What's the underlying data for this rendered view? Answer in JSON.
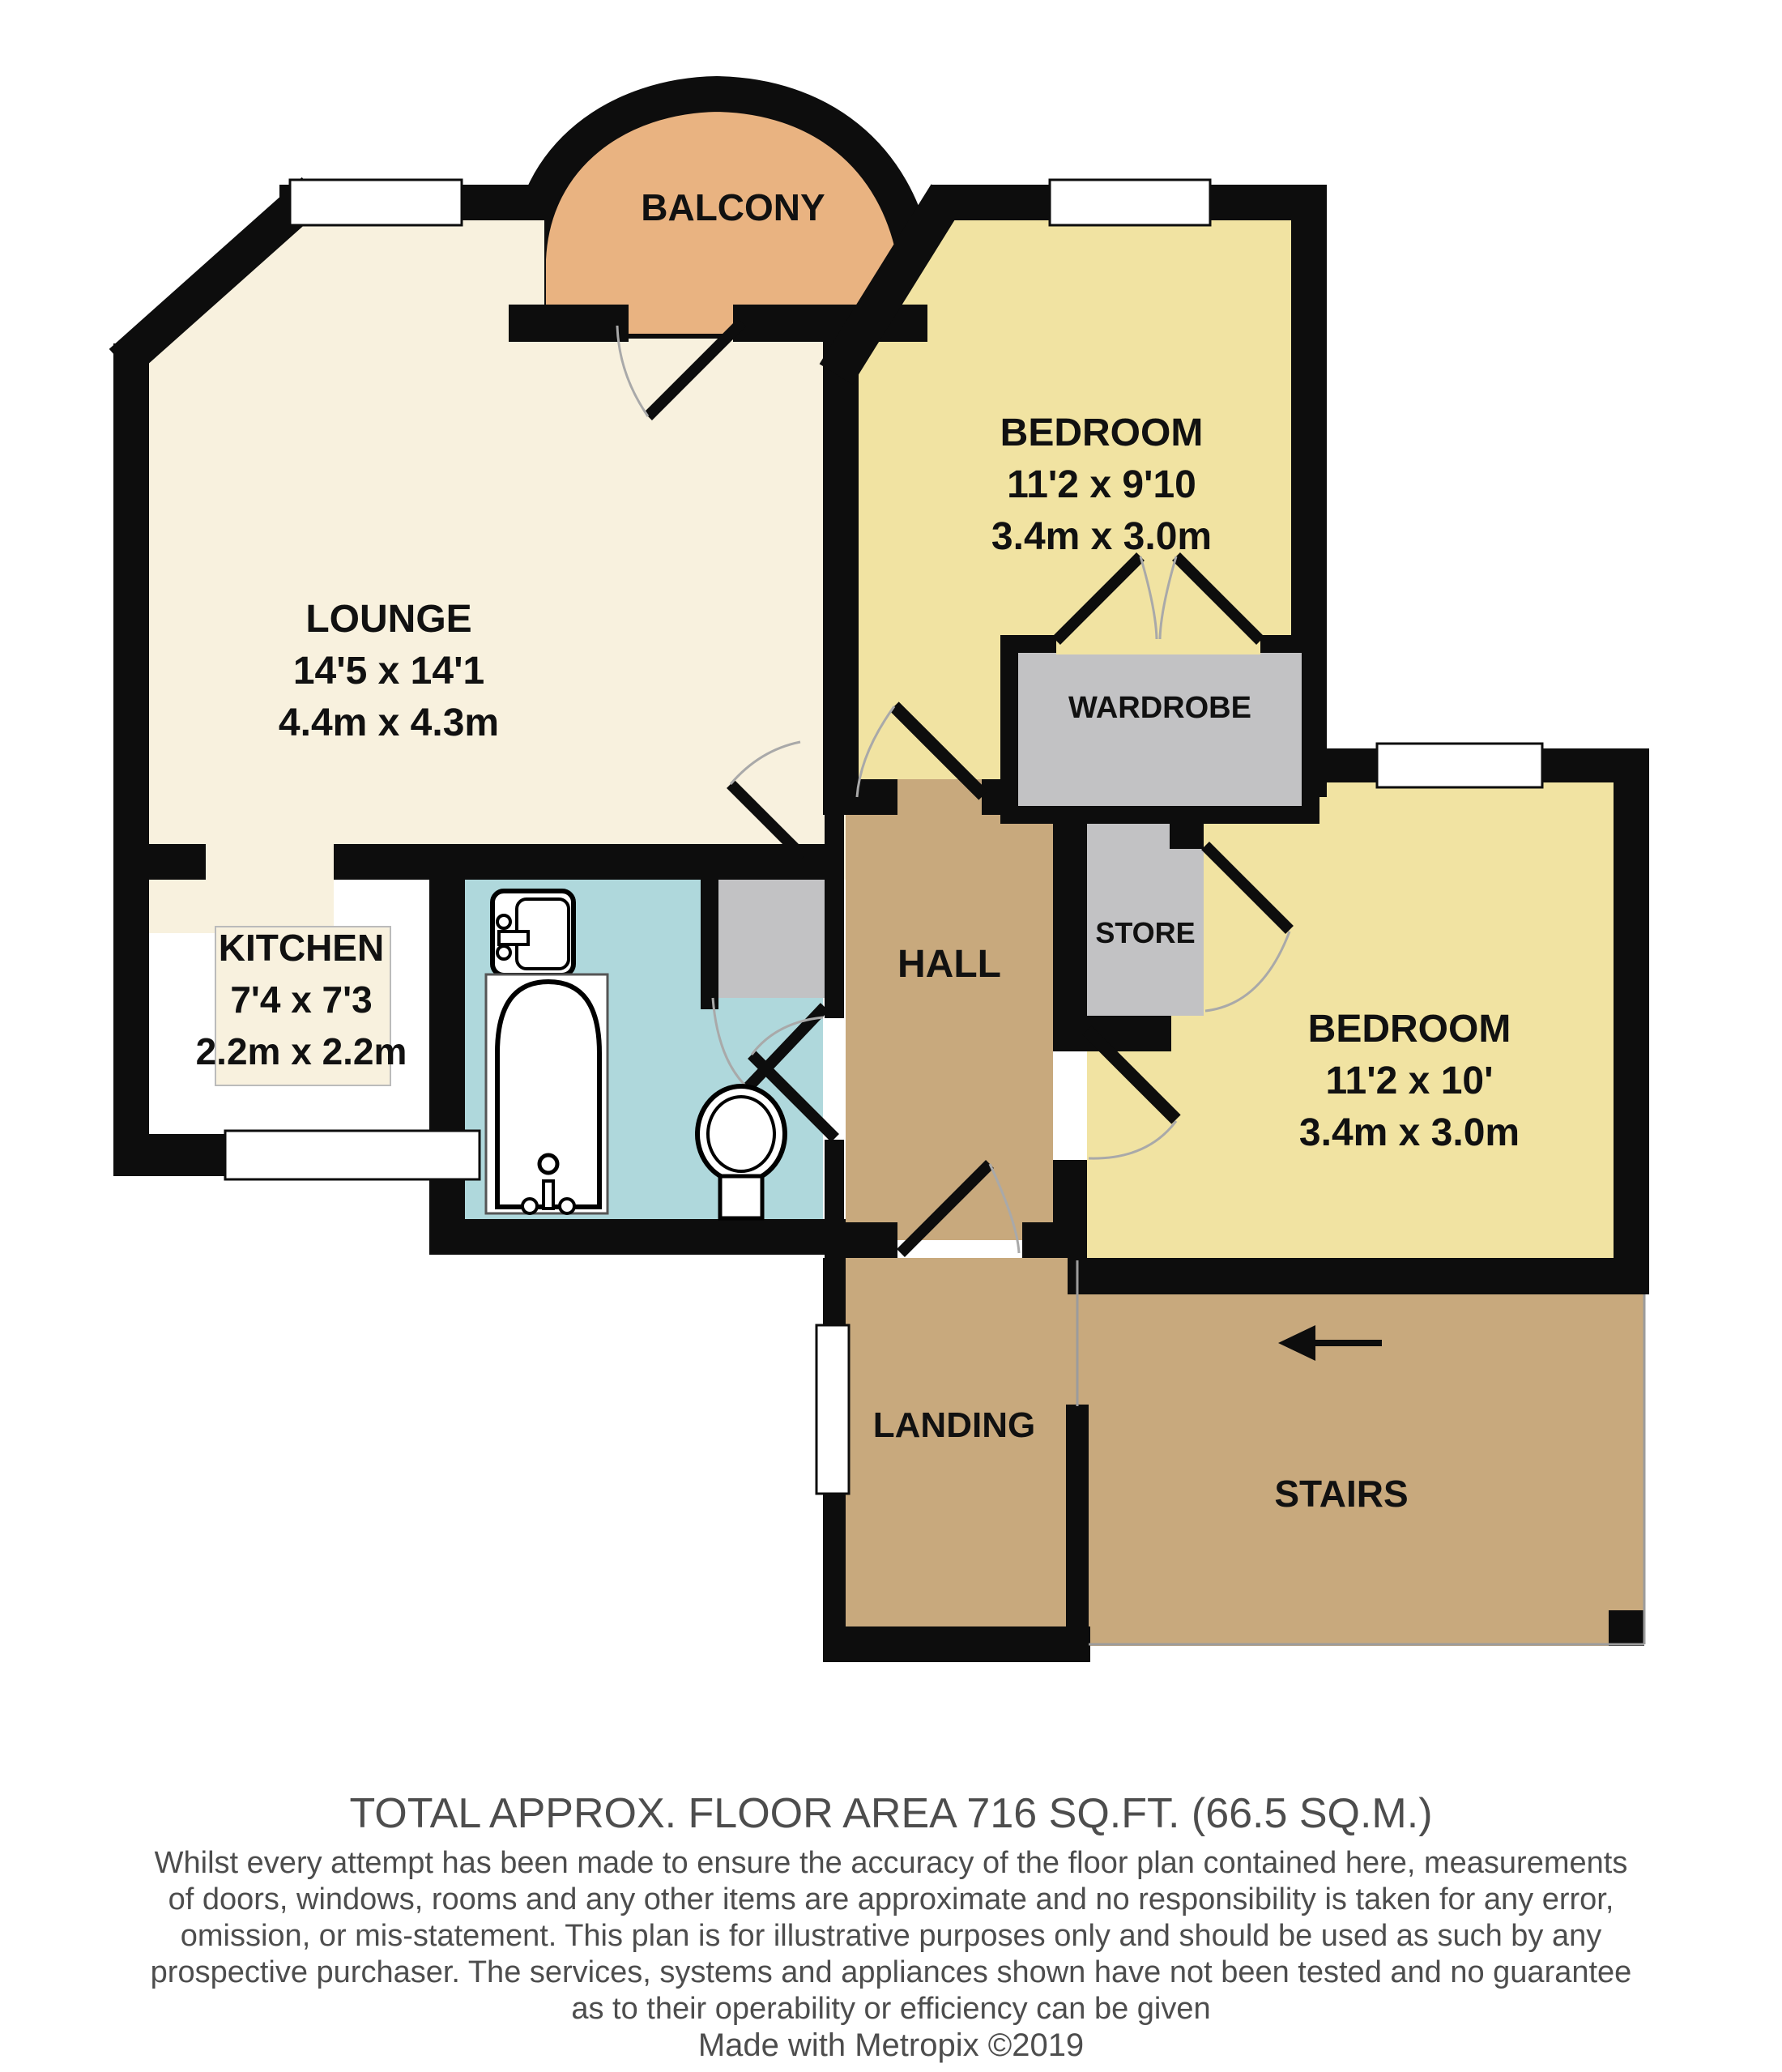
{
  "plan": {
    "rooms": {
      "balcony": {
        "name": "BALCONY"
      },
      "lounge": {
        "name": "LOUNGE",
        "imperial": "14'5 x 14'1",
        "metric": "4.4m x 4.3m"
      },
      "bedroom1": {
        "name": "BEDROOM",
        "imperial": "11'2 x 9'10",
        "metric": "3.4m x 3.0m"
      },
      "bedroom2": {
        "name": "BEDROOM",
        "imperial": "11'2 x 10'",
        "metric": "3.4m x 3.0m"
      },
      "kitchen": {
        "name": "KITCHEN",
        "imperial": "7'4 x 7'3",
        "metric": "2.2m x 2.2m"
      },
      "wardrobe": {
        "name": "WARDROBE"
      },
      "store": {
        "name": "STORE"
      },
      "hall": {
        "name": "HALL"
      },
      "landing": {
        "name": "LANDING"
      },
      "stairs": {
        "name": "STAIRS"
      }
    },
    "icons": {
      "stairs_arrow": "left-arrow"
    }
  },
  "footer": {
    "total": "TOTAL APPROX. FLOOR AREA 716 SQ.FT. (66.5 SQ.M.)",
    "disclaimer_lines": [
      "Whilst every attempt has been made to ensure the accuracy of the floor plan contained here, measurements",
      "of doors, windows, rooms and any other items are approximate and no responsibility is taken for any error,",
      "omission, or mis-statement. This plan is for illustrative purposes only and should be used as such by any",
      "prospective purchaser. The services, systems and appliances shown have not been tested and no guarantee",
      "as to their operability or efficiency can be given"
    ],
    "credit": "Made with Metropix ©2019"
  },
  "palette": {
    "cream": "#F8F1DE",
    "yellow": "#F1E3A2",
    "brown": "#C8A97D",
    "orange": "#E9B381",
    "blue": "#AFD8DC",
    "gray": "#C2C2C4",
    "wall": "#0D0D0D",
    "label": "#111111",
    "footer": "#4D4D4D",
    "arc": "#A9A9A9",
    "thinline": "#9C9C9C"
  }
}
